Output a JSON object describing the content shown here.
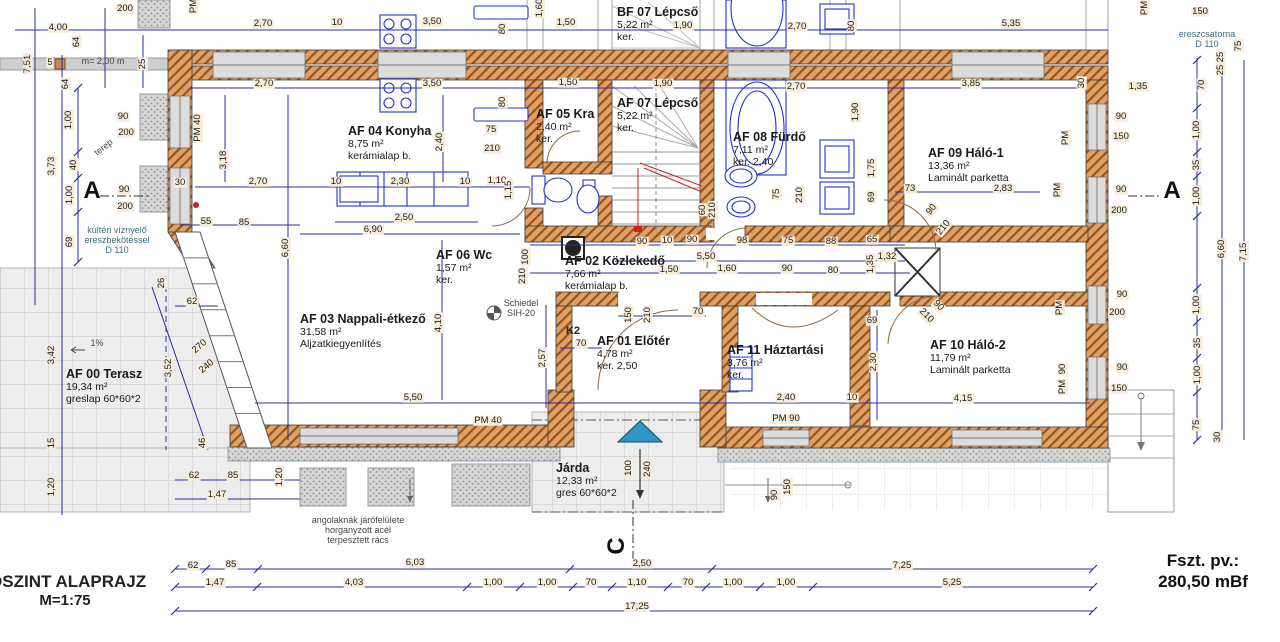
{
  "title_block": {
    "title": "DSZINT ALAPRAJZ",
    "scale": "M=1:75"
  },
  "level_block": {
    "label": "Fszt. pv.:",
    "value": "280,50 mBf"
  },
  "rooms": [
    {
      "name": "BF 07 Lépcső",
      "area": "5,22 m²",
      "finish": "ker.",
      "x": 617,
      "y": 5
    },
    {
      "name": "AF 04 Konyha",
      "area": "8,75 m²",
      "finish": "kerámialap b.",
      "x": 348,
      "y": 124
    },
    {
      "name": "AF 05 Kra",
      "area": "2,40 m²",
      "finish": "ker.",
      "x": 536,
      "y": 107
    },
    {
      "name": "AF 07 Lépcső",
      "area": "5,22 m²",
      "finish": "ker.",
      "x": 617,
      "y": 96
    },
    {
      "name": "AF 08 Fürdő",
      "area": "7,11 m²",
      "finish": "ker. 2,40",
      "x": 733,
      "y": 130
    },
    {
      "name": "AF 09 Háló-1",
      "area": "13,36 m²",
      "finish": "Laminált parketta",
      "x": 928,
      "y": 146
    },
    {
      "name": "AF 06 Wc",
      "area": "1,57 m²",
      "finish": "ker.",
      "x": 436,
      "y": 248
    },
    {
      "name": "AF 02 Közlekedő",
      "area": "7,66 m²",
      "finish": "kerámialap b.",
      "x": 565,
      "y": 254
    },
    {
      "name": "AF 03 Nappali-étkező",
      "area": "31,58 m²",
      "finish": "Aljzatkiegyenlítés",
      "x": 300,
      "y": 312
    },
    {
      "name": "AF 01 Előtér",
      "area": "4,78 m²",
      "finish": "ker. 2,50",
      "x": 597,
      "y": 334
    },
    {
      "name": "AF 11 Háztartási",
      "area": "3,76 m²",
      "finish": "ker.",
      "x": 727,
      "y": 343
    },
    {
      "name": "AF 10 Háló-2",
      "area": "11,79 m²",
      "finish": "Laminált parketta",
      "x": 930,
      "y": 338
    },
    {
      "name": "AF 00 Terasz",
      "area": "19,34 m²",
      "finish": "greslap 60*60*2",
      "x": 66,
      "y": 367
    },
    {
      "name": "Járda",
      "area": "12,33 m²",
      "finish": "gres 60*60*2",
      "x": 556,
      "y": 461
    }
  ],
  "labels": [
    {
      "t": "200",
      "x": 125,
      "y": 9
    },
    {
      "t": "4,00",
      "x": 58,
      "y": 28
    },
    {
      "t": "PM",
      "x": 194,
      "y": 6,
      "r": -90
    },
    {
      "t": "64",
      "x": 77,
      "y": 42,
      "r": -90
    },
    {
      "t": "7,51",
      "x": 28,
      "y": 64,
      "r": -90
    },
    {
      "t": "5",
      "x": 50,
      "y": 63
    },
    {
      "t": "25",
      "x": 143,
      "y": 64,
      "r": -90
    },
    {
      "t": "64",
      "x": 66,
      "y": 84,
      "r": -90
    },
    {
      "t": "2,70",
      "x": 263,
      "y": 24
    },
    {
      "t": "10",
      "x": 337,
      "y": 23
    },
    {
      "t": "3,50",
      "x": 432,
      "y": 22
    },
    {
      "t": "80",
      "x": 503,
      "y": 29,
      "r": -90
    },
    {
      "t": "1,50",
      "x": 566,
      "y": 23
    },
    {
      "t": "1,60",
      "x": 540,
      "y": 8,
      "r": -90
    },
    {
      "t": "1,90",
      "x": 683,
      "y": 26
    },
    {
      "t": "2,70",
      "x": 797,
      "y": 27
    },
    {
      "t": "80",
      "x": 852,
      "y": 26,
      "r": -90
    },
    {
      "t": "5,35",
      "x": 1011,
      "y": 24
    },
    {
      "t": "150",
      "x": 1200,
      "y": 12
    },
    {
      "t": "PM",
      "x": 1145,
      "y": 8,
      "r": -90
    },
    {
      "t": "2,70",
      "x": 264,
      "y": 84
    },
    {
      "t": "3,50",
      "x": 432,
      "y": 84
    },
    {
      "t": "80",
      "x": 503,
      "y": 102,
      "r": -90
    },
    {
      "t": "1,50",
      "x": 568,
      "y": 83
    },
    {
      "t": "1,90",
      "x": 663,
      "y": 84
    },
    {
      "t": "2,70",
      "x": 796,
      "y": 87
    },
    {
      "t": "3,85",
      "x": 971,
      "y": 84
    },
    {
      "t": "30",
      "x": 1082,
      "y": 83,
      "r": -90
    },
    {
      "t": "1,35",
      "x": 1138,
      "y": 87
    },
    {
      "t": "1,00",
      "x": 69,
      "y": 120,
      "r": -90
    },
    {
      "t": "90",
      "x": 123,
      "y": 117
    },
    {
      "t": "200",
      "x": 126,
      "y": 133
    },
    {
      "t": "PM 40",
      "x": 198,
      "y": 128,
      "r": -90
    },
    {
      "t": "3,18",
      "x": 224,
      "y": 160,
      "r": -90
    },
    {
      "t": "40",
      "x": 74,
      "y": 165,
      "r": -90
    },
    {
      "t": "3,73",
      "x": 52,
      "y": 166,
      "r": -90
    },
    {
      "t": "1,00",
      "x": 70,
      "y": 195,
      "r": -90
    },
    {
      "t": "90",
      "x": 124,
      "y": 190
    },
    {
      "t": "200",
      "x": 125,
      "y": 207
    },
    {
      "t": "69",
      "x": 70,
      "y": 242,
      "r": -90
    },
    {
      "t": "30",
      "x": 180,
      "y": 183
    },
    {
      "t": "2,70",
      "x": 258,
      "y": 182
    },
    {
      "t": "2,30",
      "x": 400,
      "y": 182
    },
    {
      "t": "10",
      "x": 336,
      "y": 182
    },
    {
      "t": "10",
      "x": 465,
      "y": 182
    },
    {
      "t": "1,10",
      "x": 497,
      "y": 181
    },
    {
      "t": "1,15",
      "x": 509,
      "y": 190,
      "r": -90
    },
    {
      "t": "2,40",
      "x": 440,
      "y": 142,
      "r": -90
    },
    {
      "t": "75",
      "x": 491,
      "y": 130
    },
    {
      "t": "210",
      "x": 492,
      "y": 149
    },
    {
      "t": "55",
      "x": 206,
      "y": 222
    },
    {
      "t": "85",
      "x": 244,
      "y": 223
    },
    {
      "t": "2,50",
      "x": 404,
      "y": 218
    },
    {
      "t": "6,90",
      "x": 373,
      "y": 230
    },
    {
      "t": "6,60",
      "x": 286,
      "y": 248,
      "r": -90
    },
    {
      "t": "100",
      "x": 526,
      "y": 257,
      "r": -90
    },
    {
      "t": "210",
      "x": 523,
      "y": 276,
      "r": -90
    },
    {
      "t": "4,10",
      "x": 439,
      "y": 323,
      "r": -90
    },
    {
      "t": "2,57",
      "x": 543,
      "y": 358,
      "r": -90
    },
    {
      "t": "5,50",
      "x": 413,
      "y": 398
    },
    {
      "t": "62",
      "x": 192,
      "y": 302
    },
    {
      "t": "26",
      "x": 162,
      "y": 283,
      "r": -90
    },
    {
      "t": "3,52",
      "x": 169,
      "y": 368,
      "r": -90
    },
    {
      "t": "270",
      "x": 200,
      "y": 347,
      "r": -40
    },
    {
      "t": "240",
      "x": 207,
      "y": 367,
      "r": -40
    },
    {
      "t": "3,42",
      "x": 52,
      "y": 355,
      "r": -90
    },
    {
      "t": "15",
      "x": 52,
      "y": 443,
      "r": -90
    },
    {
      "t": "46",
      "x": 203,
      "y": 443,
      "r": -90
    },
    {
      "t": "1,20",
      "x": 52,
      "y": 487,
      "r": -90
    },
    {
      "t": "1,20",
      "x": 280,
      "y": 477,
      "r": -90
    },
    {
      "t": "62",
      "x": 194,
      "y": 476
    },
    {
      "t": "85",
      "x": 233,
      "y": 476
    },
    {
      "t": "1,47",
      "x": 217,
      "y": 495
    },
    {
      "t": "90",
      "x": 642,
      "y": 242
    },
    {
      "t": "10",
      "x": 667,
      "y": 241
    },
    {
      "t": "90",
      "x": 692,
      "y": 240
    },
    {
      "t": "98",
      "x": 742,
      "y": 241
    },
    {
      "t": "75",
      "x": 788,
      "y": 241
    },
    {
      "t": "88",
      "x": 831,
      "y": 242
    },
    {
      "t": "65",
      "x": 872,
      "y": 240
    },
    {
      "t": "73",
      "x": 910,
      "y": 189
    },
    {
      "t": "2,83",
      "x": 1003,
      "y": 189
    },
    {
      "t": "5,50",
      "x": 706,
      "y": 257
    },
    {
      "t": "1,50",
      "x": 669,
      "y": 270
    },
    {
      "t": "1,60",
      "x": 727,
      "y": 269
    },
    {
      "t": "90",
      "x": 787,
      "y": 269
    },
    {
      "t": "80",
      "x": 833,
      "y": 271
    },
    {
      "t": "1,35",
      "x": 871,
      "y": 264,
      "r": -90
    },
    {
      "t": "1,32",
      "x": 887,
      "y": 257
    },
    {
      "t": "60",
      "x": 703,
      "y": 210,
      "r": -90
    },
    {
      "t": "210",
      "x": 713,
      "y": 210,
      "r": -90
    },
    {
      "t": "75",
      "x": 777,
      "y": 194,
      "r": -90
    },
    {
      "t": "210",
      "x": 800,
      "y": 195,
      "r": -90
    },
    {
      "t": "69",
      "x": 872,
      "y": 197,
      "r": -90
    },
    {
      "t": "1,90",
      "x": 856,
      "y": 112,
      "r": -90
    },
    {
      "t": "1,75",
      "x": 872,
      "y": 168,
      "r": -90
    },
    {
      "t": "90",
      "x": 932,
      "y": 210,
      "r": -50
    },
    {
      "t": "210",
      "x": 944,
      "y": 228,
      "r": -50
    },
    {
      "t": "90",
      "x": 938,
      "y": 306,
      "r": 45
    },
    {
      "t": "210",
      "x": 926,
      "y": 316,
      "r": 45
    },
    {
      "t": "150",
      "x": 629,
      "y": 315,
      "r": -90
    },
    {
      "t": "210",
      "x": 648,
      "y": 315,
      "r": -90
    },
    {
      "t": "70",
      "x": 581,
      "y": 344
    },
    {
      "t": "70",
      "x": 698,
      "y": 312
    },
    {
      "t": "69",
      "x": 872,
      "y": 321
    },
    {
      "t": "2,30",
      "x": 874,
      "y": 362,
      "r": -90
    },
    {
      "t": "4,15",
      "x": 963,
      "y": 399
    },
    {
      "t": "2,40",
      "x": 786,
      "y": 398
    },
    {
      "t": "10",
      "x": 852,
      "y": 398
    },
    {
      "t": "PM 90",
      "x": 786,
      "y": 419
    },
    {
      "t": "PM 40",
      "x": 488,
      "y": 421
    },
    {
      "t": "100",
      "x": 629,
      "y": 468,
      "r": -90
    },
    {
      "t": "240",
      "x": 648,
      "y": 469,
      "r": -90
    },
    {
      "t": "90",
      "x": 775,
      "y": 495,
      "r": -90
    },
    {
      "t": "150",
      "x": 788,
      "y": 487,
      "r": -90
    },
    {
      "t": "ereszcsatorna\nD 110",
      "x": 1207,
      "y": 40,
      "k": "nb"
    },
    {
      "t": "75",
      "x": 1239,
      "y": 46,
      "r": -90
    },
    {
      "t": "25",
      "x": 1221,
      "y": 57,
      "r": -90
    },
    {
      "t": "25",
      "x": 1221,
      "y": 70,
      "r": -90
    },
    {
      "t": "70",
      "x": 1202,
      "y": 85,
      "r": -90
    },
    {
      "t": "1,00",
      "x": 1197,
      "y": 130,
      "r": -90
    },
    {
      "t": "90",
      "x": 1121,
      "y": 117
    },
    {
      "t": "150",
      "x": 1121,
      "y": 137
    },
    {
      "t": "PM",
      "x": 1066,
      "y": 138,
      "r": -90
    },
    {
      "t": "35",
      "x": 1197,
      "y": 165,
      "r": -90
    },
    {
      "t": "1,00",
      "x": 1197,
      "y": 196,
      "r": -90
    },
    {
      "t": "90",
      "x": 1121,
      "y": 190
    },
    {
      "t": "200",
      "x": 1119,
      "y": 211
    },
    {
      "t": "PM",
      "x": 1058,
      "y": 190,
      "r": -90
    },
    {
      "t": "6,60",
      "x": 1222,
      "y": 249,
      "r": -90
    },
    {
      "t": "7,15",
      "x": 1244,
      "y": 252,
      "r": -90
    },
    {
      "t": "1,00",
      "x": 1197,
      "y": 305,
      "r": -90
    },
    {
      "t": "90",
      "x": 1122,
      "y": 295
    },
    {
      "t": "200",
      "x": 1117,
      "y": 313
    },
    {
      "t": "PM",
      "x": 1060,
      "y": 308,
      "r": -90
    },
    {
      "t": "35",
      "x": 1198,
      "y": 343,
      "r": -90
    },
    {
      "t": "1,00",
      "x": 1198,
      "y": 375,
      "r": -90
    },
    {
      "t": "90",
      "x": 1122,
      "y": 368
    },
    {
      "t": "150",
      "x": 1119,
      "y": 389
    },
    {
      "t": "90",
      "x": 1063,
      "y": 369,
      "r": -90
    },
    {
      "t": "PM",
      "x": 1063,
      "y": 387,
      "r": -90
    },
    {
      "t": "75",
      "x": 1197,
      "y": 425,
      "r": -90
    },
    {
      "t": "30",
      "x": 1218,
      "y": 437,
      "r": -90
    },
    {
      "t": "62",
      "x": 193,
      "y": 566
    },
    {
      "t": "85",
      "x": 231,
      "y": 565
    },
    {
      "t": "6,03",
      "x": 415,
      "y": 563
    },
    {
      "t": "2,50",
      "x": 642,
      "y": 564
    },
    {
      "t": "7,25",
      "x": 902,
      "y": 566
    },
    {
      "t": "1,47",
      "x": 215,
      "y": 583
    },
    {
      "t": "4,03",
      "x": 354,
      "y": 583
    },
    {
      "t": "1,00",
      "x": 493,
      "y": 583
    },
    {
      "t": "1,00",
      "x": 547,
      "y": 583
    },
    {
      "t": "70",
      "x": 591,
      "y": 583
    },
    {
      "t": "1,10",
      "x": 637,
      "y": 583
    },
    {
      "t": "70",
      "x": 688,
      "y": 583
    },
    {
      "t": "1,00",
      "x": 733,
      "y": 583
    },
    {
      "t": "1,00",
      "x": 786,
      "y": 583
    },
    {
      "t": "5,25",
      "x": 952,
      "y": 583
    },
    {
      "t": "17,25",
      "x": 637,
      "y": 607
    },
    {
      "t": "m= 2,00 m",
      "x": 103,
      "y": 62,
      "k": "n"
    },
    {
      "t": "terep",
      "x": 104,
      "y": 148,
      "r": -38,
      "k": "n"
    },
    {
      "t": "kültéri víznyelő\nereszbekötéssel\nD 110",
      "x": 117,
      "y": 241,
      "k": "nb"
    },
    {
      "t": "1%",
      "x": 97,
      "y": 344,
      "k": "n"
    },
    {
      "t": "Schiedel\nSIH-20",
      "x": 521,
      "y": 309,
      "k": "n"
    },
    {
      "t": "K2",
      "x": 573,
      "y": 331,
      "k": "k2"
    },
    {
      "t": "angolaknák járófelülete\nhorganyzott acél\nterpesztett rács",
      "x": 358,
      "y": 531,
      "k": "n"
    },
    {
      "t": "A",
      "x": 92,
      "y": 191,
      "k": "m"
    },
    {
      "t": "A",
      "x": 1172,
      "y": 191,
      "k": "m"
    },
    {
      "t": "C",
      "x": 617,
      "y": 546,
      "r": -90,
      "k": "m"
    }
  ],
  "colors": {
    "dimension_blue": "#2b2ba8",
    "wall_fill": "#e0a066",
    "wall_hatch": "#94551f",
    "entry_marker": "#2e97c8",
    "accent_red": "#cc2222"
  }
}
